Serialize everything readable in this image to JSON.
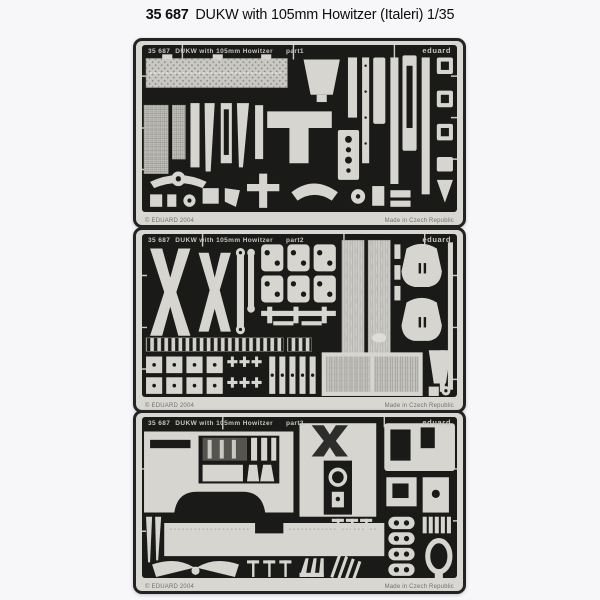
{
  "header": {
    "catalog_number": "35 687",
    "product_title": "DUKW with 105mm Howitzer (Italeri) 1/35"
  },
  "frets": [
    {
      "catalog": "35 687",
      "title": "DUKW with 105mm Howitzer",
      "part_label": "part1",
      "brand": "eduard",
      "copyright": "© EDUARD 2004",
      "made_in": "Made in Czech Republic"
    },
    {
      "catalog": "35 687",
      "title": "35 687 DUKW with 105mm Howitzer",
      "part_label": "part2",
      "brand": "eduard",
      "copyright": "© EDUARD 2004",
      "made_in": "Made in Czech Republic"
    },
    {
      "catalog": "35 687",
      "title": "DUKW with 105mm Howitzer",
      "part_label": "part3",
      "brand": "eduard",
      "copyright": "© EDUARD 2004",
      "made_in": "Made in Czech Republic"
    }
  ],
  "colors": {
    "page_background": "#f7f7fa",
    "fret_metal": "#d6d5d0",
    "fret_cavity": "#1a1a19",
    "fret_border": "#232323",
    "etched_text": "#c6c5c0"
  }
}
